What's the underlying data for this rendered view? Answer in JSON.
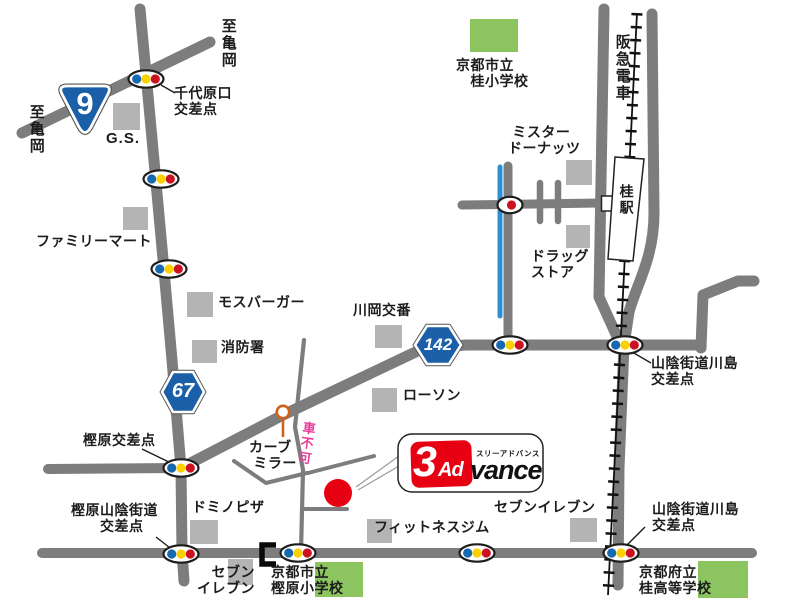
{
  "labels": {
    "to_kameoka_top": "至亀岡",
    "to_kameoka_left": "至亀岡",
    "chiyoharaguchi": "千代原口\n交差点",
    "gs": "G.S.",
    "familymart": "ファミリーマート",
    "mos_burger": "モスバーガー",
    "fire_station": "消防署",
    "kawaoka_koban": "川岡交番",
    "lawson": "ローソン",
    "katsura_elementary": "京都市立\n　桂小学校",
    "mister_donut": " ミスター\nドーナッツ",
    "drug_store": "ドラッグ\nストア",
    "hankyu_railway": "阪急電車",
    "katsura_station": "桂駅",
    "sanin_kawashima_mid": "山陰街道川島\n交差点",
    "kashihara_intersection": "樫原交差点",
    "curve_mirror": "カーブ\n ミラー",
    "kuruma_fuka": "車不可",
    "kashihara_sanin": "樫原山陰街道\n　　交差点",
    "dominos_pizza": "ドミノピザ",
    "seven_eleven_left": "　セブン\nイレブン",
    "kashihara_elementary": "京都市立\n樫原小学校",
    "fitness_gym": "フィットネスジム",
    "seven_eleven_right": "セブンイレブン",
    "sanin_kawashima_bottom": "山陰街道川島\n交差点",
    "katsura_high": "京都府立\n桂高等学校"
  },
  "route_shields": {
    "national_9": "9",
    "prefectural_67": "67",
    "prefectural_142": "142"
  },
  "logo": {
    "three": "3",
    "ad": "Ad",
    "vance": "vance",
    "katakana": "スリーアドバンス"
  },
  "colors": {
    "road": "#7d7d7d",
    "building_gray": "#b4b4b4",
    "building_green": "#8cc45f",
    "route_blue": "#1a5fa8",
    "accent_red": "#e60012",
    "signal_blue": "#1668b0",
    "signal_yellow": "#fdd000",
    "signal_red": "#cc1122",
    "river_blue": "#2d8fd6",
    "no_car_pink": "#e83d9a",
    "mirror_orange": "#d2601d"
  }
}
